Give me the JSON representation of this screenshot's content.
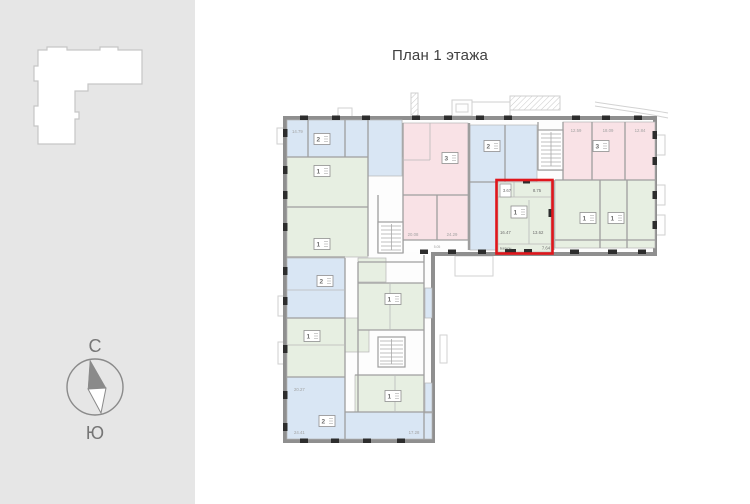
{
  "header": {
    "title": "План 1 этажа"
  },
  "compass": {
    "north": "С",
    "south": "Ю"
  },
  "colors": {
    "sidebar_gray": "#e6e6e6",
    "wall_gray": "#8f8f8f",
    "apartment_blue": "#d9e6f4",
    "apartment_green": "#e7efe2",
    "apartment_pink": "#f9e2e6",
    "highlight_red": "#e0161c"
  },
  "plan": {
    "badges": [
      "2",
      "1",
      "1",
      "2",
      "1",
      "2",
      "1",
      "1",
      "3",
      "2",
      "3",
      "1",
      "1"
    ],
    "rooms": [
      "14.79",
      "20.08",
      "24.29",
      "5.05",
      "12.59",
      "18.09",
      "12.84",
      "24.41",
      "17.28",
      "20.27"
    ],
    "highlight": {
      "badge": "1",
      "bath": "3.67",
      "hall": "8.75",
      "living": "16.47",
      "kitchen": "13.62",
      "balcony_label": "Балкон",
      "balcony_area": "7.64"
    }
  }
}
